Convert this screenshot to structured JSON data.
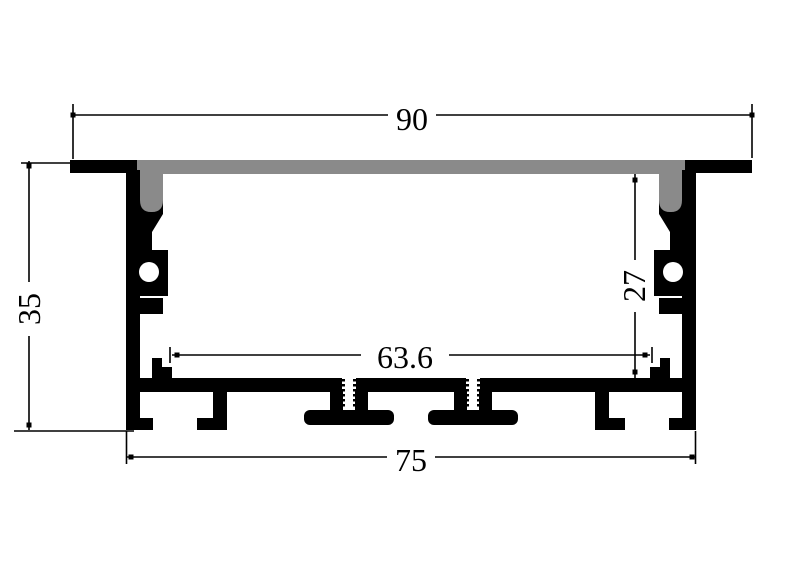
{
  "drawing": {
    "dimensions": {
      "overall_width": "90",
      "overall_height": "35",
      "inner_height": "27",
      "inner_width": "63.6",
      "base_width": "75"
    },
    "colors": {
      "outline": "#000000",
      "diffuser_fill": "#8a8a8a",
      "background": "#ffffff"
    }
  }
}
